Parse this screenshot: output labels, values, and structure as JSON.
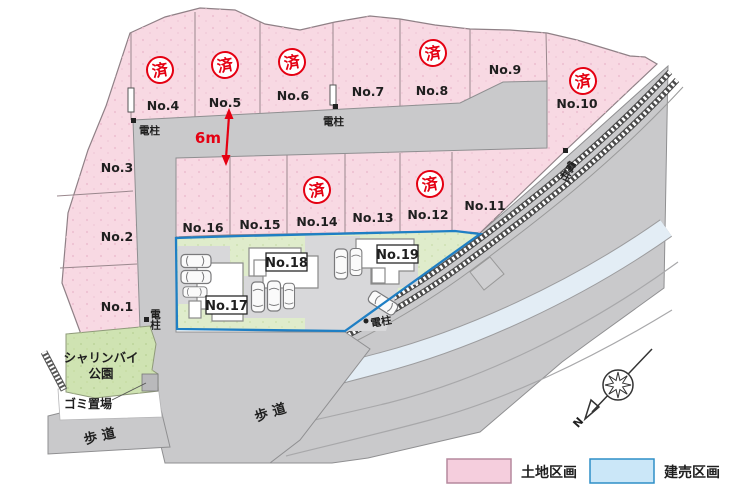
{
  "sold_stamp": "済",
  "plots": [
    {
      "label": "No.1",
      "sold": false
    },
    {
      "label": "No.2",
      "sold": false
    },
    {
      "label": "No.3",
      "sold": false
    },
    {
      "label": "No.4",
      "sold": true
    },
    {
      "label": "No.5",
      "sold": true
    },
    {
      "label": "No.6",
      "sold": true
    },
    {
      "label": "No.7",
      "sold": false
    },
    {
      "label": "No.8",
      "sold": true
    },
    {
      "label": "No.9",
      "sold": false
    },
    {
      "label": "No.10",
      "sold": true
    },
    {
      "label": "No.11",
      "sold": false
    },
    {
      "label": "No.12",
      "sold": true
    },
    {
      "label": "No.13",
      "sold": false
    },
    {
      "label": "No.14",
      "sold": true
    },
    {
      "label": "No.15",
      "sold": false
    },
    {
      "label": "No.16",
      "sold": false
    },
    {
      "label": "No.17",
      "sold": false
    },
    {
      "label": "No.18",
      "sold": false
    },
    {
      "label": "No.19",
      "sold": false
    }
  ],
  "annotations": {
    "road_width": "6m",
    "pole": "電柱",
    "sidewalk": "歩道",
    "garbage": "ゴミ置場",
    "park_line1": "シャリンバイ",
    "park_line2": "公園",
    "north": "N"
  },
  "legend": [
    {
      "label": "土地区画",
      "color": "#f5cedd",
      "border": "#b5899d"
    },
    {
      "label": "建売区画",
      "color": "#cbe7f8",
      "border": "#2e8fc7"
    }
  ],
  "colors": {
    "plot_pink": "#f8d9e3",
    "road_gray": "#c9c9cb",
    "park_green": "#cfe3b2",
    "lawn_green": "#dfeccb",
    "sale_border_blue": "#1f7fc4",
    "stamp_red": "#e50012",
    "rail_band_blue": "#e3edf5"
  }
}
